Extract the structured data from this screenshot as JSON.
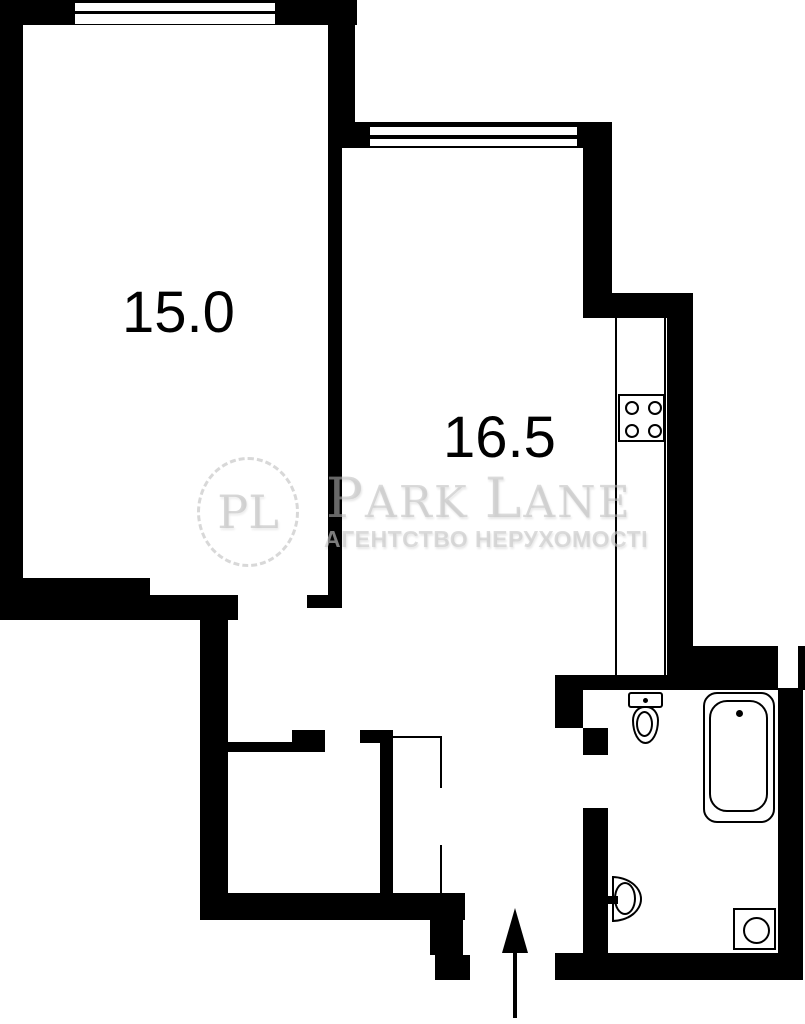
{
  "plan": {
    "type": "apartment-floor-plan",
    "rooms": [
      {
        "id": "room-1",
        "area_label": "15.0"
      },
      {
        "id": "room-2",
        "area_label": "16.5"
      }
    ],
    "fixtures": {
      "kitchen": [
        "counter",
        "stove-4-burners"
      ],
      "bathroom": [
        "toilet",
        "bathtub",
        "washbasin",
        "washing-machine"
      ],
      "hall": [
        "wardrobe-dashed",
        "entrance-arrow-up"
      ]
    },
    "windows": 2,
    "watermark": {
      "logo_initials": "PL",
      "brand_p1": "P",
      "brand_p2": "ARK",
      "brand_p3": "L",
      "brand_p4": "ANE",
      "tagline": "АГЕНТСТВО НЕРУХОМОСТІ"
    },
    "colors": {
      "wall": "#000000",
      "background": "#ffffff",
      "watermark": "#bdbdbd"
    }
  }
}
